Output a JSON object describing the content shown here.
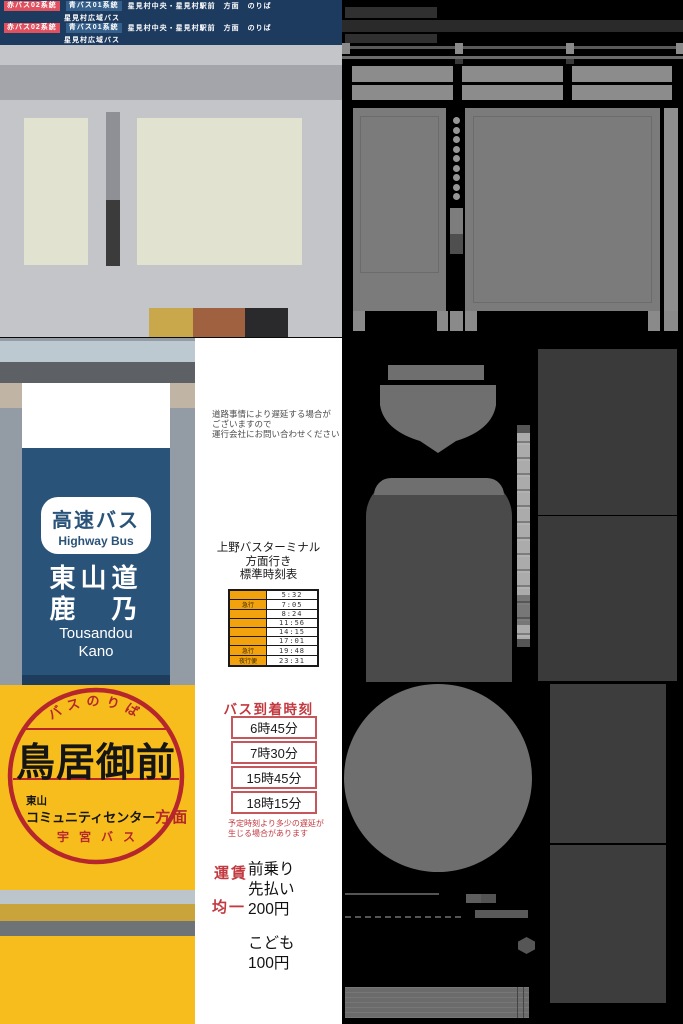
{
  "palette": {
    "banner-bg": "#1d3a5f",
    "badge-red": "#e0505e",
    "badge-blue": "#36608c",
    "sign-blue": "#2a5379",
    "sign-yellow": "#f7bd1c",
    "stamp-red": "#b5272d",
    "accent-red": "#c23a40",
    "timetable-orange": "#f2a20d"
  },
  "material_swatches": [
    "#c8a84b",
    "#9f6140",
    "#2a2a2c"
  ],
  "route_banner": {
    "red_badge": "赤バス02系統",
    "blue_badge": "青バス01系統",
    "destination": "星見村中央・星見村駅前　方面　のりば",
    "sub_line": "星見村広域バス"
  },
  "highway_sign": {
    "title_jp": "高速バス",
    "title_en": "Highway Bus",
    "dest_line1": "東山道",
    "dest_line2": "鹿　乃",
    "romaji_line1": "Tousandou",
    "romaji_line2": "Kano"
  },
  "stop_sign": {
    "arc_label": "バスのりば",
    "stop_name": "鳥居御前",
    "area_small": "東山",
    "area_main": "コミュニティセンター",
    "direction_suffix": "方面",
    "operator": "宇宮バス"
  },
  "delay_notice": {
    "line1": "道路事情により遅延する場合が",
    "line2": "ございますので",
    "line3": "運行会社にお問い合わせください"
  },
  "timetable": {
    "header_line1": "上野バスターミナル",
    "header_line2": "方面行き",
    "header_line3": "標準時刻表",
    "rows": [
      {
        "type": "",
        "time": "5:32"
      },
      {
        "type": "急行",
        "time": "7:05"
      },
      {
        "type": "",
        "time": "8:24"
      },
      {
        "type": "",
        "time": "11:56"
      },
      {
        "type": "",
        "time": "14:15"
      },
      {
        "type": "",
        "time": "17:01"
      },
      {
        "type": "急行",
        "time": "19:48"
      },
      {
        "type": "夜行便",
        "time": "23:31"
      }
    ]
  },
  "arrival_board": {
    "title": "バス到着時刻",
    "times": [
      "6時45分",
      "7時30分",
      "15時45分",
      "18時15分"
    ],
    "note_line1": "予定時刻より多少の遅延が",
    "note_line2": "生じる場合があります"
  },
  "fare": {
    "fare_label": "運賃",
    "flat_label": "均一",
    "boarding_line1": "前乗り",
    "boarding_line2": "先払い",
    "adult_price": "200円",
    "child_label": "こども",
    "child_price": "100円"
  }
}
